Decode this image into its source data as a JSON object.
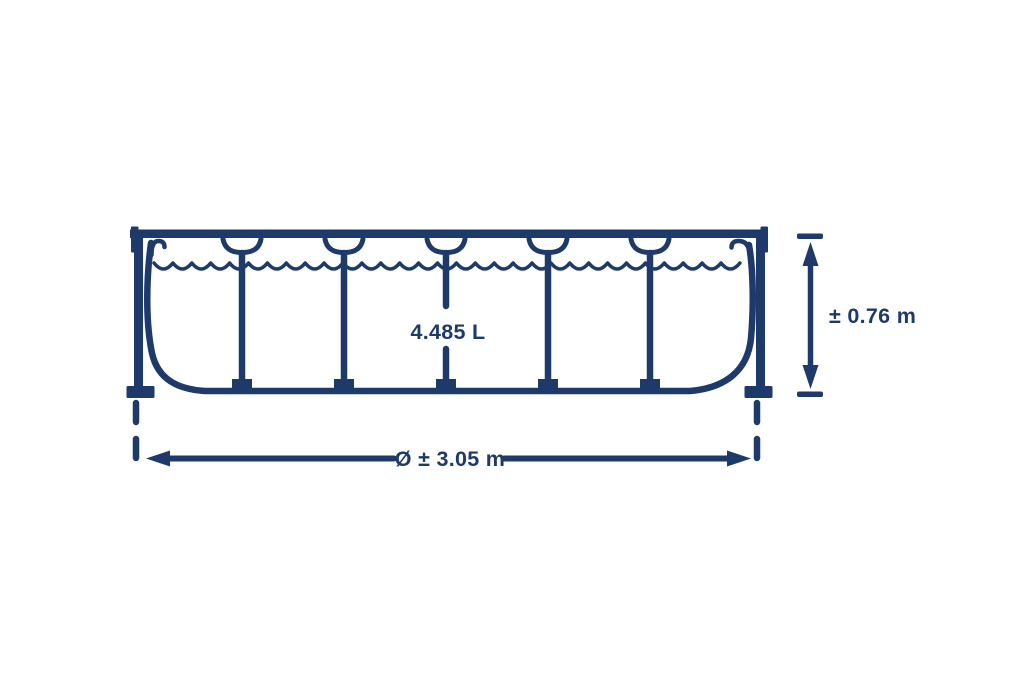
{
  "diagram": {
    "capacity_label": "4.485 L",
    "height_label": "± 0.76 m",
    "diameter_label": "Ø ± 3.05 m"
  },
  "colors": {
    "line": "#1e3a6b",
    "background": "#ffffff"
  }
}
